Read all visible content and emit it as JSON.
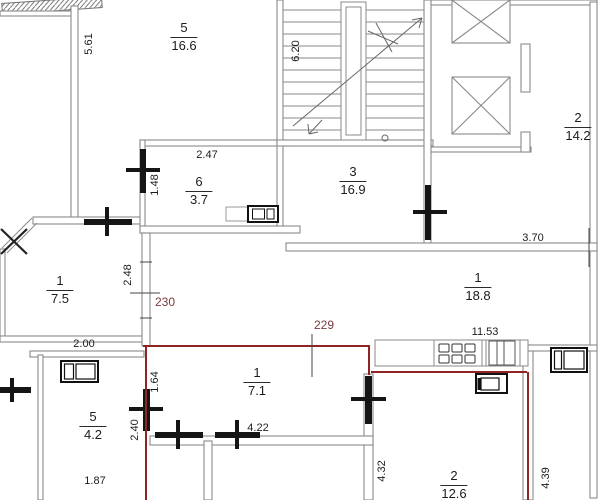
{
  "plan": {
    "type": "apartment-floor-plan",
    "rooms": [
      {
        "number": "5",
        "area": "16.6"
      },
      {
        "number": "6",
        "area": "3.7"
      },
      {
        "number": "3",
        "area": "16.9"
      },
      {
        "number": "2",
        "area": "14.2"
      },
      {
        "number": "1",
        "area": "7.5"
      },
      {
        "number": "1",
        "area": "18.8"
      },
      {
        "number": "5",
        "area": "4.2"
      },
      {
        "number": "1",
        "area": "7.1"
      },
      {
        "number": "2",
        "area": "12.6"
      }
    ],
    "dimensions": [
      {
        "value": "5.61"
      },
      {
        "value": "6.20"
      },
      {
        "value": "2.47"
      },
      {
        "value": "1.48"
      },
      {
        "value": "2.48"
      },
      {
        "value": "3.70"
      },
      {
        "value": "2.00"
      },
      {
        "value": "11.53"
      },
      {
        "value": "1.64"
      },
      {
        "value": "2.40"
      },
      {
        "value": "4.22"
      },
      {
        "value": "1.87"
      },
      {
        "value": "4.32"
      },
      {
        "value": "4.39"
      }
    ],
    "unit_labels": [
      {
        "value": "230"
      },
      {
        "value": "229"
      }
    ],
    "colors": {
      "wall_gray": "#8a8a8a",
      "wall_red": "#8e2424",
      "label_red": "#7b3b3b",
      "marker": "#151515"
    }
  }
}
